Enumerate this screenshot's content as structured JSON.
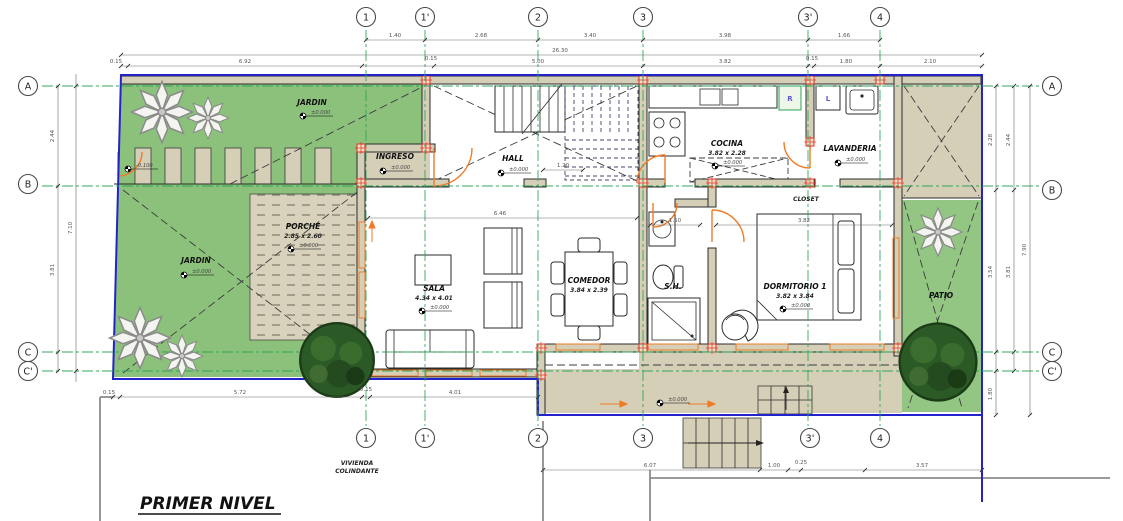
{
  "drawing": {
    "title": "PRIMER NIVEL",
    "neighbor_note_line1": "VIVIENDA",
    "neighbor_note_line2": "COLINDANTE"
  },
  "grid": {
    "columns": [
      "1",
      "1'",
      "2",
      "3",
      "3'",
      "4"
    ],
    "rows": [
      "A",
      "B",
      "C",
      "C'"
    ]
  },
  "rooms": {
    "jardin_top": {
      "name": "JARDIN",
      "level": "±0.000"
    },
    "jardin_left": {
      "name": "JARDIN",
      "level": "±0.000"
    },
    "ingreso": {
      "name": "INGRESO",
      "level": "±0.000"
    },
    "hall": {
      "name": "HALL",
      "level": "±0.000"
    },
    "porche": {
      "name": "PORCHE",
      "dims": "2.85 x 2.60",
      "level": "±0.000"
    },
    "sala": {
      "name": "SALA",
      "dims": "4.34 x 4.01",
      "level": "±0.000"
    },
    "comedor": {
      "name": "COMEDOR",
      "dims": "3.84 x 2.39"
    },
    "cocina": {
      "name": "COCINA",
      "dims": "3.82 x 2.28",
      "level": "±0.000"
    },
    "lavanderia": {
      "name": "LAVANDERIA",
      "level": "±0.000"
    },
    "closet": {
      "name": "CLOSET"
    },
    "sh": {
      "name": "S.H."
    },
    "dormitorio1": {
      "name": "DORMITORIO 1",
      "dims": "3.82 x 3.84",
      "level": "±0.000"
    },
    "patio": {
      "name": "PATIO"
    },
    "terraza_level": "±0.000",
    "walkway_level": "-0.100"
  },
  "appliances": {
    "fridge": "R",
    "washer": "L"
  },
  "dimensions": {
    "overall_width": "26.30",
    "top_chain": [
      "1.40",
      "2.68",
      "3.40",
      "3.98",
      "1.66"
    ],
    "detail_chain": [
      "0.15",
      "6.92",
      "0.15",
      "5.00",
      "3.82",
      "0.15",
      "1.80",
      "2.10"
    ],
    "left_inner": [
      "2.44",
      "3.81"
    ],
    "left_total": "7.10",
    "right_inner": [
      "2.28",
      "3.54",
      "1.80"
    ],
    "right_outer": [
      "2.44",
      "3.81"
    ],
    "right_total": "7.90",
    "bottom_left_chain": [
      "0.15",
      "5.72",
      "0.15",
      "4.01"
    ],
    "bottom_right_chain": [
      "6.07",
      "1.00",
      "0.25",
      "3.57"
    ],
    "inner_dims": [
      "6.46",
      "1.20",
      "1.50",
      "3.82"
    ]
  },
  "colors": {
    "lot_line": "#2323cc",
    "garden_green": "#8cc17c",
    "floor_tan": "#d5cfb8",
    "door_orange": "#ef7b25",
    "column_red": "#e23324",
    "grid_green": "#2ba355"
  }
}
